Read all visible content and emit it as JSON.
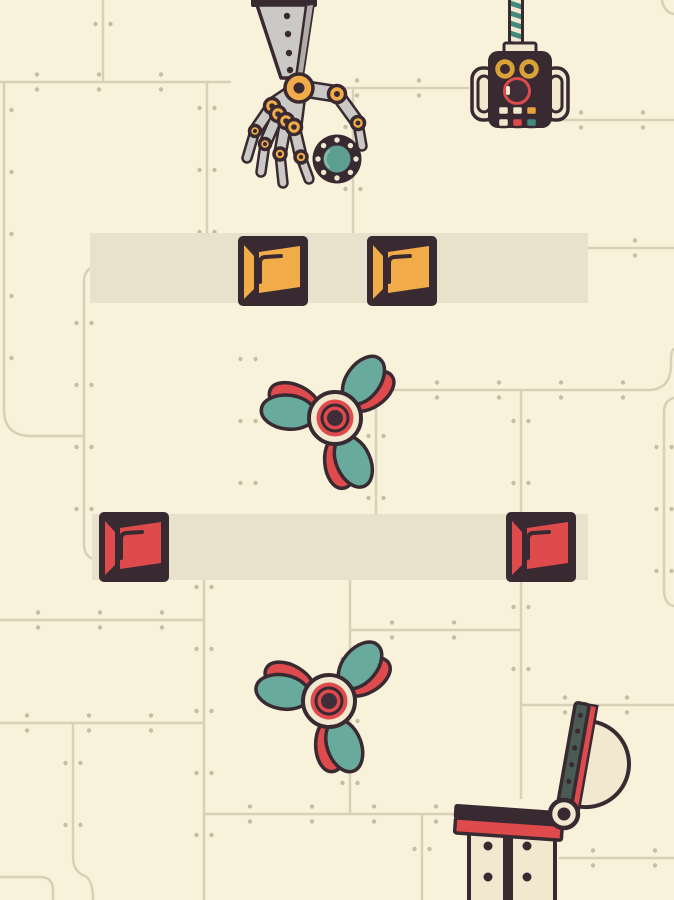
{
  "app": {
    "title": "steampunk contraption puzzle game screen",
    "visible_text": ""
  },
  "colors": {
    "background": "#f9f2da",
    "seam": "#d9d0b8",
    "rivet": "#c6bda5",
    "band": "#e8e1cb",
    "outline": "#392a32",
    "yellow": "#f1ac49",
    "red": "#df4a4c",
    "teal": "#68aa9b",
    "teal_dark": "#44897d",
    "ball_teal": "#5c9e90",
    "metal": "#cbc9c5",
    "metal_dark": "#b0ada9",
    "cream": "#f1e8cf",
    "slate": "#4a5b54",
    "eye_yellow": "#d8a237",
    "button_orange": "#e5a33f",
    "core_plum": "#3f2e37",
    "highlight_teal": "#86b9aa"
  },
  "scene": {
    "claw": {
      "label": "mechanical claw arm holding riveted gear ball"
    },
    "ball": {
      "cx": 337,
      "cy": 159,
      "label": "riveted gear ball"
    },
    "remote": {
      "label": "remote control handset hanging from striped cable"
    },
    "tracks": [
      {
        "id": "track-top",
        "x": 90,
        "y": 233,
        "w": 498,
        "h": 70,
        "label": "upper slide track"
      },
      {
        "id": "track-bottom",
        "x": 92,
        "y": 514,
        "w": 496,
        "h": 66,
        "label": "lower slide track"
      }
    ],
    "blocks": [
      {
        "id": "yellow-block-left",
        "x": 237,
        "y": 235,
        "color": "yellow",
        "label": "yellow push block"
      },
      {
        "id": "yellow-block-right",
        "x": 366,
        "y": 235,
        "color": "yellow",
        "label": "yellow push block"
      },
      {
        "id": "red-block-left",
        "x": 98,
        "y": 511,
        "color": "red",
        "label": "red push block"
      },
      {
        "id": "red-block-right",
        "x": 505,
        "y": 511,
        "color": "red",
        "label": "red push block"
      }
    ],
    "propellers": [
      {
        "id": "propeller-top",
        "cx": 335,
        "cy": 418,
        "rotation": 0,
        "label": "three-blade propeller"
      },
      {
        "id": "propeller-bottom",
        "cx": 329,
        "cy": 701,
        "rotation": 4,
        "label": "three-blade propeller"
      }
    ],
    "flipper": {
      "pivot_x": 564,
      "pivot_y": 814,
      "arm_angle": 10,
      "platform_tilt": 4,
      "label": "hinged flipper platform"
    }
  }
}
